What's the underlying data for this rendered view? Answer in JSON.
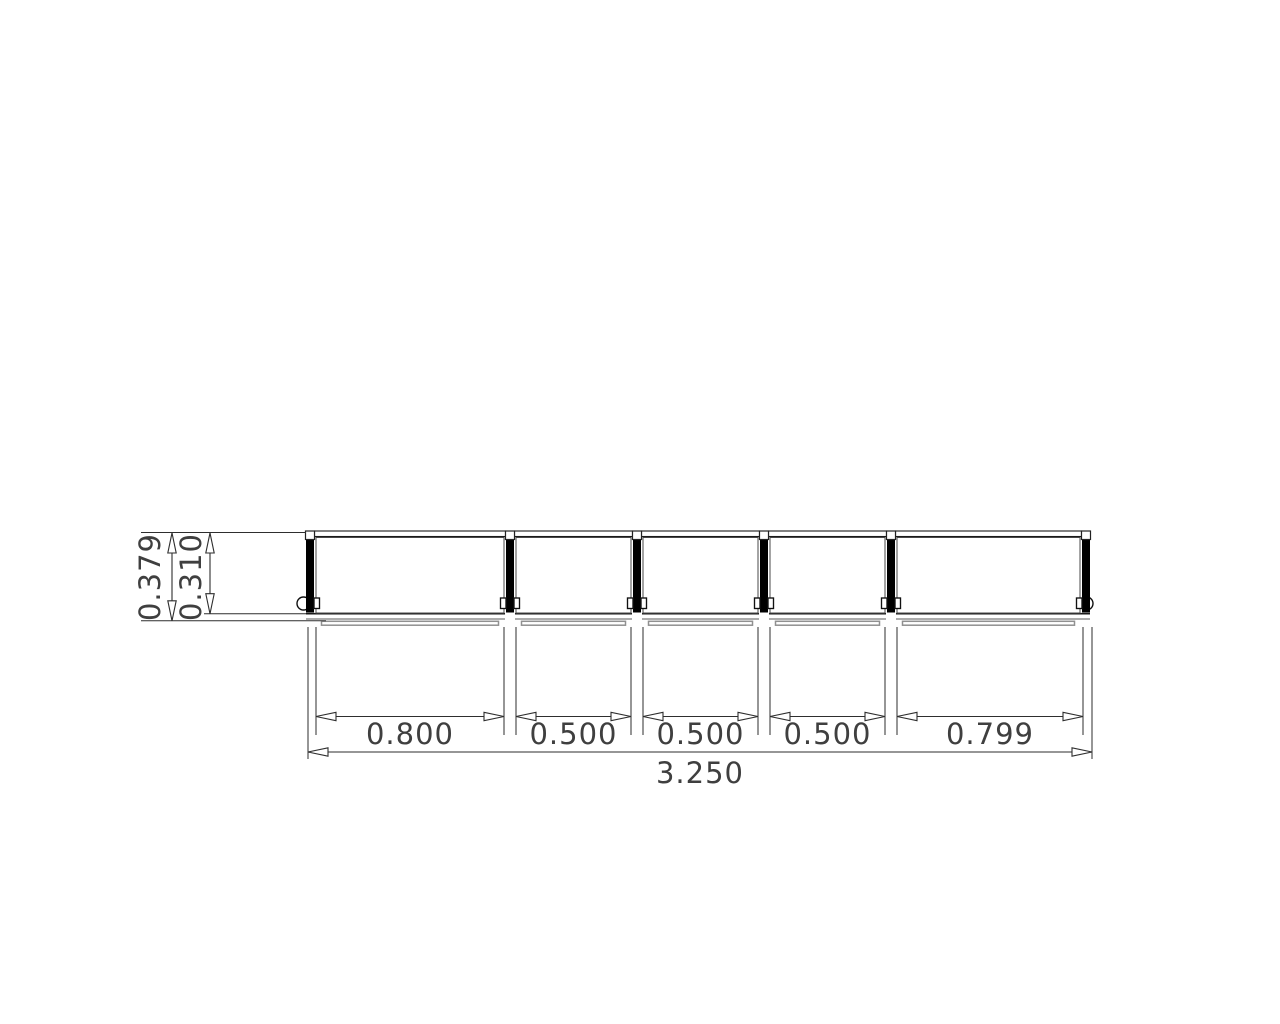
{
  "drawing": {
    "type": "cad-elevation-balustrade",
    "panel_count": 5,
    "post_count": 6,
    "colors": {
      "line": "#1a1a1a",
      "dim_line": "#2e2e2e",
      "gray": "#909090",
      "text": "#3f3f3f",
      "background": "#ffffff",
      "post_fill": "#000000"
    },
    "horizontal_dimensions": {
      "segments": [
        "0.800",
        "0.500",
        "0.500",
        "0.500",
        "0.799"
      ],
      "overall": "3.250"
    },
    "vertical_dimensions": {
      "outer": "0.379",
      "inner": "0.310"
    }
  }
}
